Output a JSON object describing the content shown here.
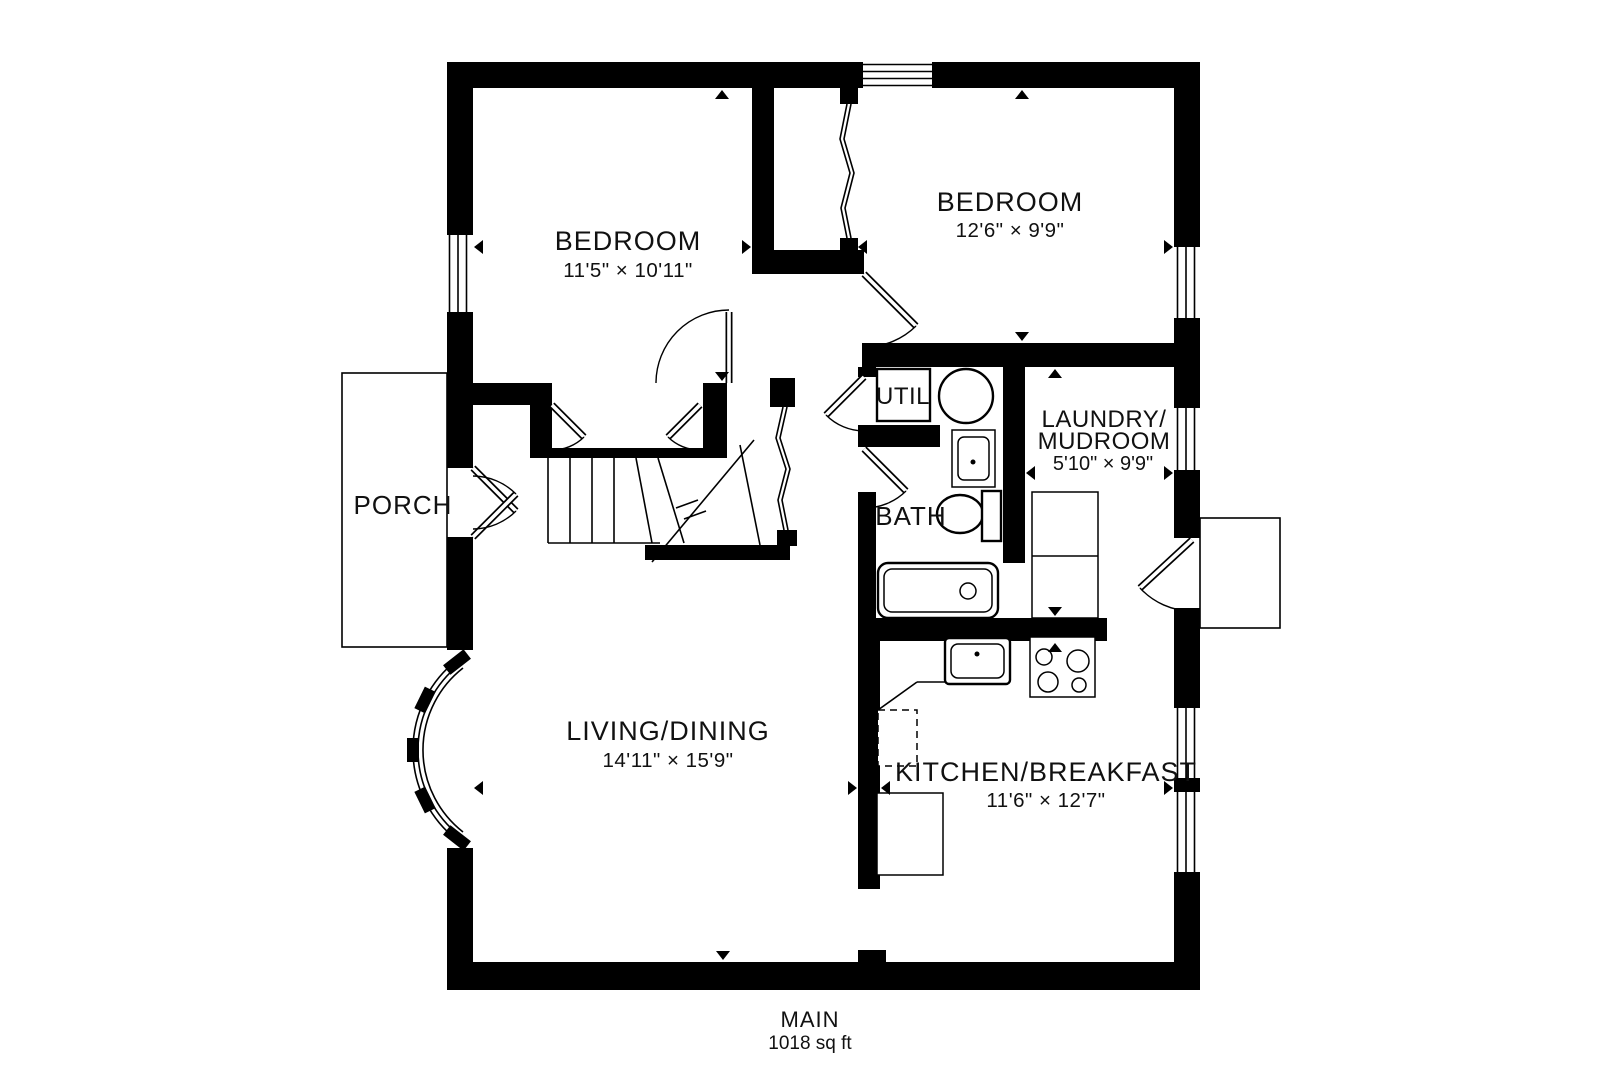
{
  "floor": {
    "label": "MAIN",
    "area": "1018 sq ft"
  },
  "rooms": {
    "bedroom1": {
      "name": "BEDROOM",
      "dims": "11'5\" × 10'11\""
    },
    "bedroom2": {
      "name": "BEDROOM",
      "dims": "12'6\" × 9'9\""
    },
    "living": {
      "name": "LIVING/DINING",
      "dims": "14'11\" × 15'9\""
    },
    "kitchen": {
      "name": "KITCHEN/BREAKFAST",
      "dims": "11'6\" × 12'7\""
    },
    "laundry": {
      "name_line1": "LAUNDRY/",
      "name_line2": "MUDROOM",
      "dims": "5'10\" × 9'9\""
    },
    "bath": {
      "name": "BATH"
    },
    "util": {
      "name": "UTIL"
    },
    "porch": {
      "name": "PORCH"
    }
  },
  "colors": {
    "walls": "#000000",
    "background": "#ffffff"
  },
  "fixtures": [
    "stairs",
    "stair-break-line",
    "bifold-closet-doors",
    "bow-window",
    "water-heater",
    "washer-dryer",
    "toilet",
    "bathtub",
    "bath-sink",
    "kitchen-sink",
    "stove",
    "dishwasher",
    "kitchen-counter",
    "porch-deck",
    "entry-stoop"
  ]
}
